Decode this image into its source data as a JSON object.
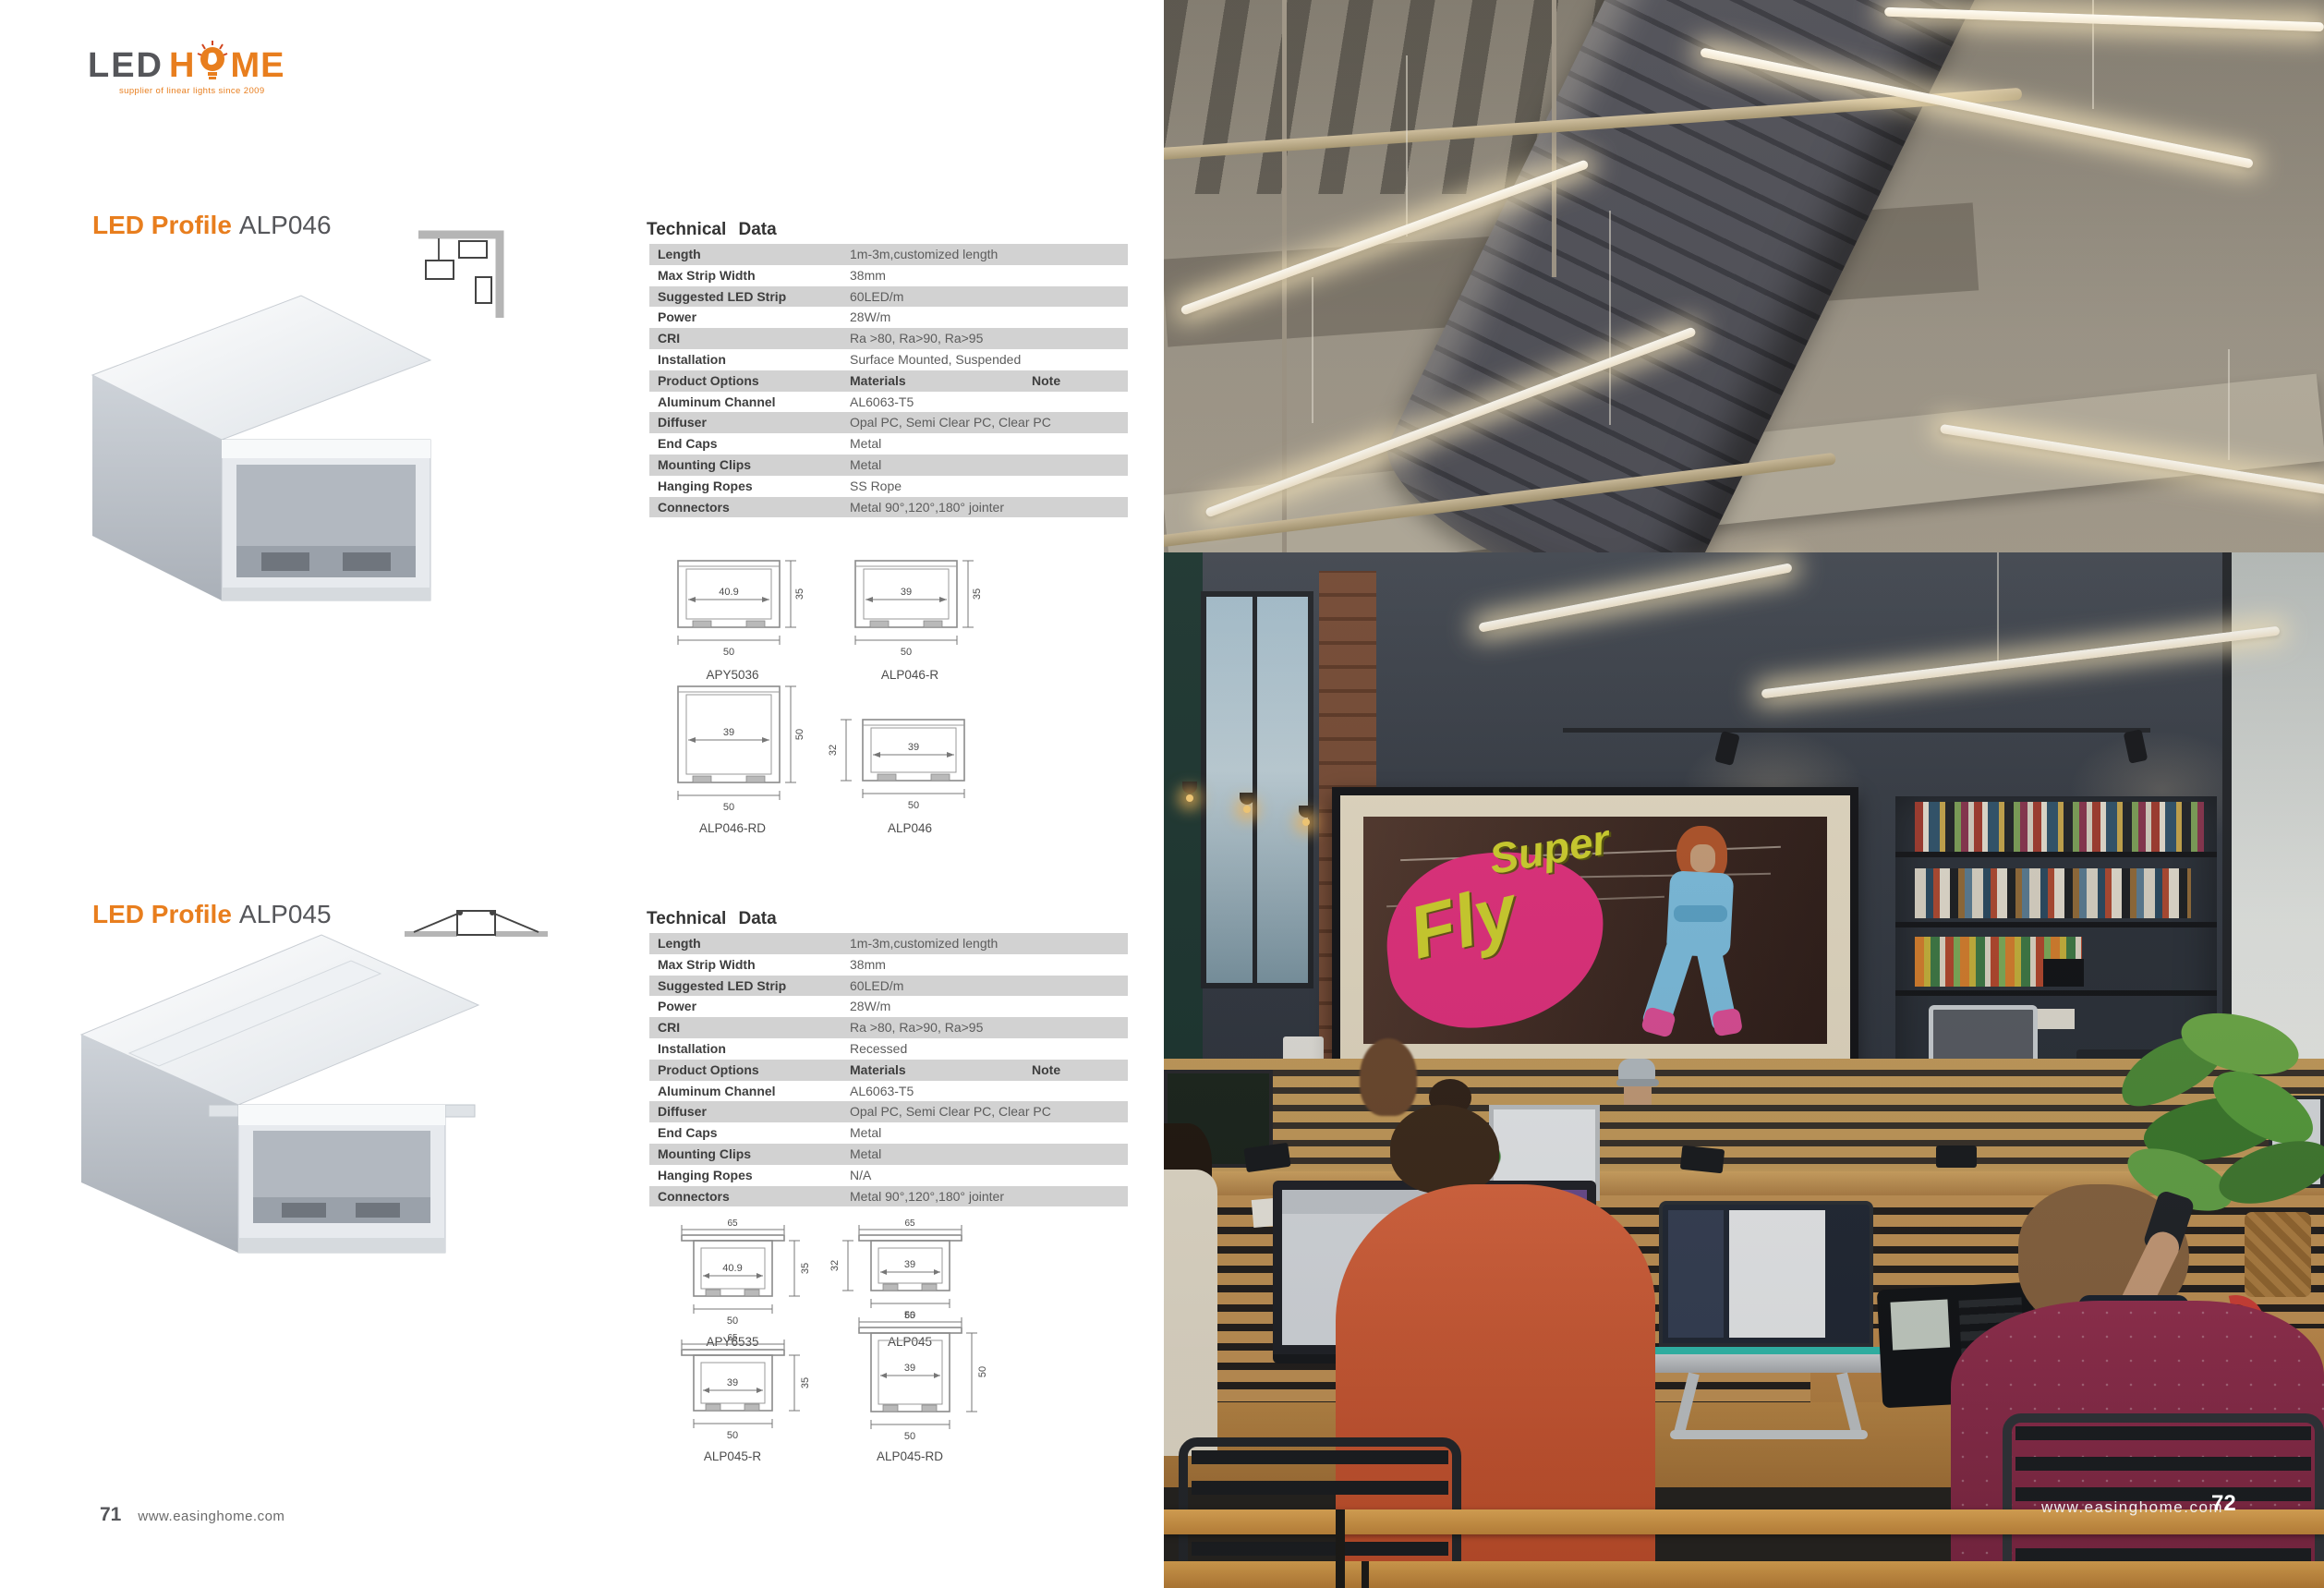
{
  "logo": {
    "led": "LED",
    "h": "H",
    "me": "ME",
    "tagline": "supplier of linear lights since 2009"
  },
  "footer_left": {
    "page_number": "71",
    "website": "www.easinghome.com"
  },
  "footer_right": {
    "website": "www.easinghome.com",
    "page_number": "72"
  },
  "poster": {
    "line1": "Super",
    "line2": "Fly"
  },
  "colors": {
    "accent_orange": "#e87e1e",
    "table_row_gray": "#d2d2d2",
    "wall_charcoal": "#3a404a",
    "wood_slat": "#c8935a",
    "poster_pink": "#e73180",
    "poster_yellow": "#d3d52f",
    "led_warm_white": "#fff3dd"
  },
  "sections": [
    {
      "title_highlight": "LED Profile",
      "title_model": "ALP046",
      "tech_title": "Technical Data",
      "rows": [
        {
          "label": "Length",
          "value": "1m-3m,customized length"
        },
        {
          "label": "Max Strip Width",
          "value": "38mm"
        },
        {
          "label": "Suggested LED Strip",
          "value": "60LED/m"
        },
        {
          "label": "Power",
          "value": "28W/m"
        },
        {
          "label": "CRI",
          "value": "Ra >80, Ra>90, Ra>95"
        },
        {
          "label": "Installation",
          "value": "Surface Mounted, Suspended"
        },
        {
          "label": "Product Options",
          "value": "Materials",
          "note": "Note"
        },
        {
          "label": "Aluminum Channel",
          "value": "AL6063-T5"
        },
        {
          "label": "Diffuser",
          "value": "Opal PC, Semi Clear PC, Clear PC"
        },
        {
          "label": "End Caps",
          "value": "Metal"
        },
        {
          "label": "Mounting Clips",
          "value": "Metal"
        },
        {
          "label": "Hanging Ropes",
          "value": "SS Rope"
        },
        {
          "label": "Connectors",
          "value": "Metal 90°,120°,180° jointer"
        }
      ],
      "drawings": [
        {
          "name": "APY5036",
          "inner_width": "40.9",
          "height": "35",
          "bottom_width": "50"
        },
        {
          "name": "ALP046-R",
          "inner_width": "39",
          "height": "35",
          "bottom_width": "50"
        },
        {
          "name": "ALP046-RD",
          "inner_width": "39",
          "height": "50",
          "bottom_width": "50"
        },
        {
          "name": "ALP046",
          "inner_width": "39",
          "height": "32",
          "bottom_width": "50"
        }
      ]
    },
    {
      "title_highlight": "LED Profile",
      "title_model": "ALP045",
      "tech_title": "Technical Data",
      "rows": [
        {
          "label": "Length",
          "value": "1m-3m,customized length"
        },
        {
          "label": "Max Strip Width",
          "value": "38mm"
        },
        {
          "label": "Suggested LED Strip",
          "value": "60LED/m"
        },
        {
          "label": "Power",
          "value": "28W/m"
        },
        {
          "label": "CRI",
          "value": "Ra >80, Ra>90, Ra>95"
        },
        {
          "label": "Installation",
          "value": "Recessed"
        },
        {
          "label": "Product Options",
          "value": "Materials",
          "note": "Note"
        },
        {
          "label": "Aluminum Channel",
          "value": "AL6063-T5"
        },
        {
          "label": "Diffuser",
          "value": "Opal PC, Semi Clear PC, Clear PC"
        },
        {
          "label": "End Caps",
          "value": "Metal"
        },
        {
          "label": "Mounting Clips",
          "value": "Metal"
        },
        {
          "label": "Hanging Ropes",
          "value": "N/A"
        },
        {
          "label": "Connectors",
          "value": "Metal 90°,120°,180° jointer"
        }
      ],
      "drawings": [
        {
          "name": "APY6535",
          "top_width": "65",
          "inner_width": "40.9",
          "height": "35",
          "bottom_width": "50"
        },
        {
          "name": "ALP045",
          "top_width": "65",
          "inner_width": "39",
          "height": "32",
          "bottom_width": "50"
        },
        {
          "name": "ALP045-R",
          "top_width": "65",
          "inner_width": "39",
          "height": "35",
          "bottom_width": "50"
        },
        {
          "name": "ALP045-RD",
          "top_width": "65",
          "inner_width": "39",
          "height": "50",
          "bottom_width": "50"
        }
      ]
    }
  ]
}
